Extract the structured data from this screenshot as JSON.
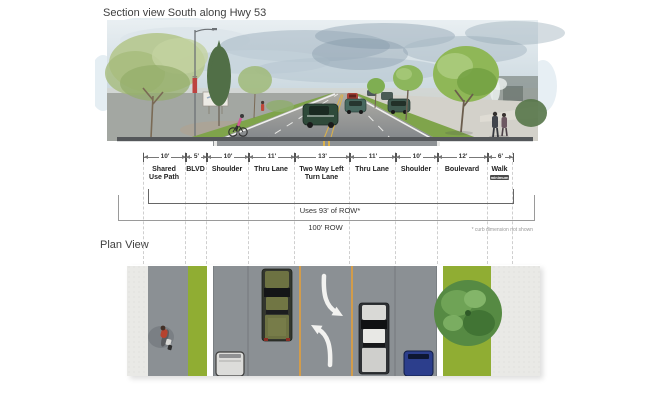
{
  "section_view": {
    "title": "Section view South along Hwy 53"
  },
  "dimensions": {
    "segments": [
      {
        "width": "10'",
        "label": "Shared Use Path"
      },
      {
        "width": "5'",
        "label": "BLVD"
      },
      {
        "width": "10'",
        "label": "Shoulder"
      },
      {
        "width": "11'",
        "label": "Thru Lane"
      },
      {
        "width": "13'",
        "label": "Two Way Left Turn Lane"
      },
      {
        "width": "11'",
        "label": "Thru Lane"
      },
      {
        "width": "10'",
        "label": "Shoulder"
      },
      {
        "width": "12'",
        "label": "Boulevard"
      },
      {
        "width": "6'",
        "label": "Walk",
        "note": "minimum"
      }
    ],
    "row_used_label": "Uses 93' of ROW*",
    "row_total_label": "100' ROW",
    "footnote": "* curb dimension not shown"
  },
  "plan_view": {
    "title": "Plan View"
  },
  "colors": {
    "boulevard_green": "#90ad33",
    "pavement_gray": "#8b9094",
    "sidewalk_gray": "#e9e9e6",
    "turn_lane_line_orange": "#df9f3e",
    "dimension_line": "#555555",
    "guide_line": "#cfcfcf"
  }
}
